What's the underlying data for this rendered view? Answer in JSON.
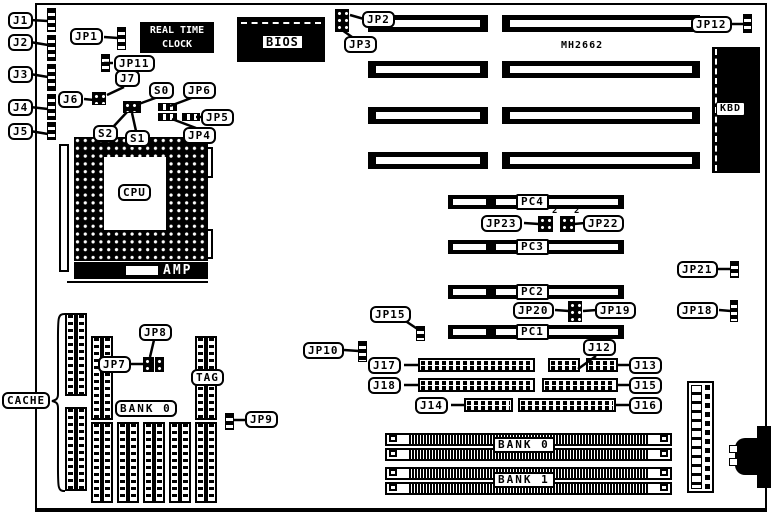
{
  "figure": {
    "type": "motherboard-diagram",
    "chipset_text": "MH2662"
  },
  "blocks": {
    "rtc_line1": "REAL TIME",
    "rtc_line2": "CLOCK",
    "bios": "BIOS",
    "kbd": "KBD",
    "cpu": "CPU",
    "amp": "AMP",
    "cache": "CACHE",
    "tag": "TAG",
    "cache_bank": "BANK 0",
    "simm_bank0": "BANK 0",
    "simm_bank1": "BANK 1"
  },
  "pci_slots": [
    "PC4",
    "PC3",
    "PC2",
    "PC1"
  ],
  "callouts": {
    "j1": "J1",
    "j2": "J2",
    "j3": "J3",
    "j4": "J4",
    "j5": "J5",
    "jp1": "JP1",
    "jp11": "JP11",
    "j6": "J6",
    "j7": "J7",
    "s0": "S0",
    "s1": "S1",
    "s2": "S2",
    "jp6": "JP6",
    "jp5": "JP5",
    "jp4": "JP4",
    "jp2": "JP2",
    "jp3": "JP3",
    "jp12": "JP12",
    "jp23": "JP23",
    "jp22": "JP22",
    "jp21": "JP21",
    "jp20": "JP20",
    "jp19": "JP19",
    "jp18": "JP18",
    "jp15": "JP15",
    "jp10": "JP10",
    "j17": "J17",
    "j18": "J18",
    "j14": "J14",
    "j12": "J12",
    "j13": "J13",
    "j15": "J15",
    "j16": "J16",
    "jp7": "JP7",
    "jp8": "JP8",
    "jp9": "JP9"
  },
  "pin_markers": {
    "jp23_pin": "2",
    "jp22_pin": "2"
  }
}
